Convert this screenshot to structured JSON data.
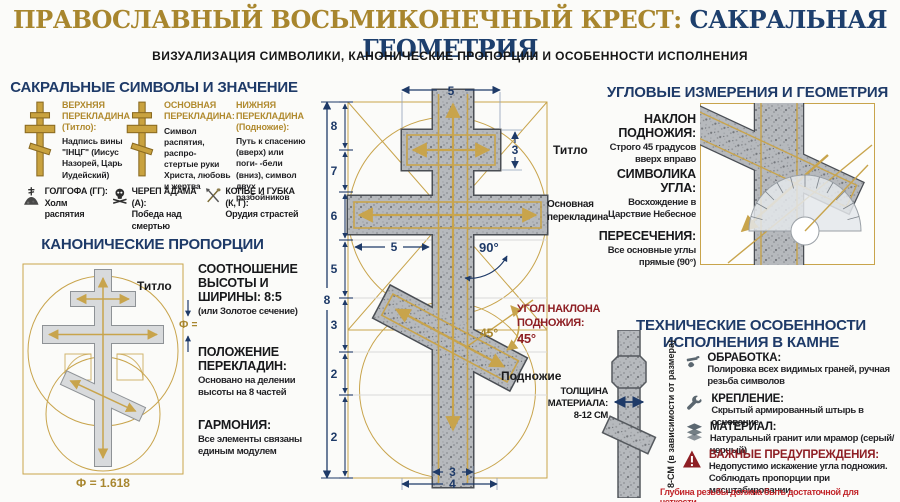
{
  "header": {
    "title_gold": "ПРАВОСЛАВНЫЙ ВОСЬМИКОНЕЧНЫЙ КРЕСТ:",
    "title_blue": " САКРАЛЬНАЯ ГЕОМЕТРИЯ",
    "subtitle": "ВИЗУАЛИЗАЦИЯ СИМВОЛИКИ, КАНОНИЧЕСКИЕ ПРОПОРЦИИ И ОСОБЕННОСТИ ИСПОЛНЕНИЯ"
  },
  "symbols_section": {
    "heading": "САКРАЛЬНЫЕ СИМВОЛЫ И ЗНАЧЕНИЕ",
    "columns": [
      {
        "title": "ВЕРХНЯЯ ПЕРЕКЛАДИНА",
        "subtitle": "(Титло):",
        "body": "Надпись вины \"ІНЦГ\" (Иисус Назорей, Царь Иудейский)"
      },
      {
        "title": "ОСНОВНАЯ ПЕРЕКЛАДИНА:",
        "subtitle": "",
        "body": "Символ распятия, распро- стертые руки Христа, любовь и жертва"
      },
      {
        "title": "НИЖНЯЯ ПЕРЕКЛАДИНА",
        "subtitle": "(Подножие):",
        "body": "Путь к спасению (вверх) или поги- -бели (вниз), символ двух разбойников"
      }
    ],
    "glossary": [
      {
        "term": "ГОЛГОФА (ГГ):",
        "desc": "Холм распятия"
      },
      {
        "term": "ЧЕРЕП АДАМА (А):",
        "desc": "Победа над смертью"
      },
      {
        "term": "КОПЬЕ И ГУБКА (К, Г):",
        "desc": "Орудия страстей"
      }
    ]
  },
  "proportions_section": {
    "heading": "КАНОНИЧЕСКИЕ ПРОПОРЦИИ",
    "diagram": {
      "titlo_label": "Титло",
      "phi_label": "Ф =",
      "phi_value": "Ф = 1.618"
    },
    "items": [
      {
        "title": "СООТНОШЕНИЕ ВЫСОТЫ И ШИРИНЫ: 8:5",
        "body": "(или Золотое сечение)"
      },
      {
        "title": "ПОЛОЖЕНИЕ ПЕРЕКЛАДИН:",
        "body": "Основано на делении высоты на 8 частей"
      },
      {
        "title": "ГАРМОНИЯ:",
        "body": "Все элементы связаны единым модулем"
      }
    ]
  },
  "blueprint": {
    "top_width": "5",
    "total_height": "8",
    "segments": [
      "8",
      "7",
      "6",
      "5",
      "3",
      "2",
      "2"
    ],
    "titlo_dim": "3",
    "titlo_label": "Титло",
    "main_label_line1": "Основная",
    "main_label_line2": "перекладина",
    "half_width": "5",
    "right_angle": "90°",
    "foot_angle": "45°",
    "angle_note_line1": "УГОЛ НАКЛОНА",
    "angle_note_line2": "ПОДНОЖИЯ:",
    "angle_note_line3": "45°",
    "foot_label": "Подножие",
    "bottom_inner": "3",
    "bottom_outer": "4"
  },
  "angles_section": {
    "heading": "УГЛОВЫЕ ИЗМЕРЕНИЯ И ГЕОМЕТРИЯ",
    "items": [
      {
        "title": "НАКЛОН ПОДНОЖИЯ:",
        "body": "Строго 45 градусов вверх вправо"
      },
      {
        "title": "СИМВОЛИКА УГЛА:",
        "body": "Восхождение в Царствие Небесное"
      },
      {
        "title": "ПЕРЕСЕЧЕНИЯ:",
        "body": "Все основные углы прямые (90°)"
      }
    ]
  },
  "technical_section": {
    "heading_line1": "ТЕХНИЧЕСКИЕ ОСОБЕННОСТИ",
    "heading_line2": "ИСПОЛНЕНИЯ В КАМНЕ",
    "thickness_lines": [
      "ТОЛЩИНА",
      "МАТЕРИАЛА:",
      "8-12 СМ"
    ],
    "thickness_note": "8-СМ (в зависимости от размера)",
    "items": [
      {
        "title": "ОБРАБОТКА:",
        "body": "Полировка всех видимых граней, ручная резьба символов"
      },
      {
        "title": "КРЕПЛЕНИЕ:",
        "body": "Скрытый армированный штырь в основание"
      },
      {
        "title": "МАТЕРИАЛ:",
        "body": "Натуральный гранит или мрамор (серый/черный)"
      }
    ],
    "warning": {
      "title": "ВАЖНЫЕ ПРЕДУПРЕЖДЕНИЯ:",
      "line1": "Недопустимо искажение угла подножия.",
      "line2": "Соблюдать пропорции при масштабировании.",
      "line3": "Глубина резьбы должна быть достаточной для четкости."
    }
  },
  "colors": {
    "gold": "#a8862e",
    "navy": "#1e3a68",
    "dark_red": "#8e1f24",
    "red": "#c2262b"
  }
}
